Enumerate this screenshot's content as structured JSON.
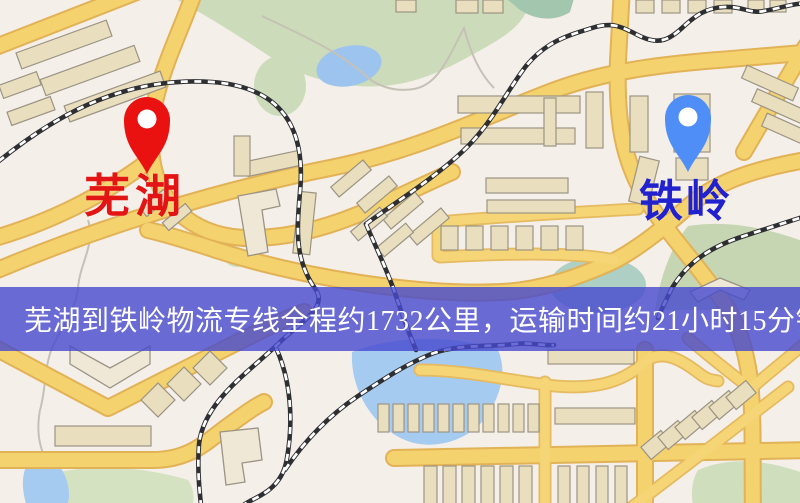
{
  "banner": {
    "text": "芜湖到铁岭物流专线全程约1732公里，运输时间约21小时15分钟.",
    "background_color": "#484ace",
    "text_color": "#ffffff"
  },
  "markers": {
    "origin": {
      "label": "芜湖",
      "pin_color": "#ea1111",
      "label_color": "#e31414",
      "pin_icon": "map-pin"
    },
    "destination": {
      "label": "铁岭",
      "pin_color": "#4f8ef6",
      "label_color": "#2121cd",
      "pin_icon": "map-pin"
    }
  },
  "map_colors": {
    "background": "#f5efe9",
    "road_fill": "#f4d26e",
    "road_casing": "#e2b257",
    "building": "#e9debe",
    "park_green": "#ccdcba",
    "water_blue": "#a6cbf0",
    "railway_dark": "#2e2f33"
  }
}
